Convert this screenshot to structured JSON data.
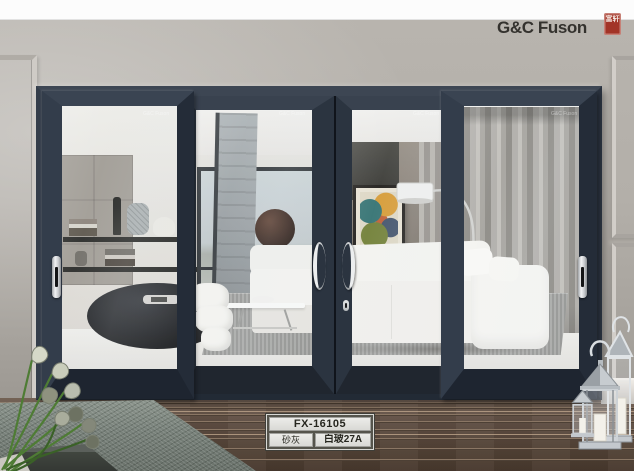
{
  "brand": {
    "logo_text": "G&C Fuson",
    "seal_text": "富轩",
    "watermark": "G&C Fuson"
  },
  "product_label": {
    "model": "FX-16105",
    "frame_color": "砂灰",
    "glass_spec": "白玻27A"
  },
  "colors": {
    "door_frame": "#2e3744",
    "brand_seal_red": "#a23427",
    "wall_grey": "#b3afa9",
    "deck_wood_brown": "#5c4b40",
    "label_cell": "#e6e5e2"
  }
}
